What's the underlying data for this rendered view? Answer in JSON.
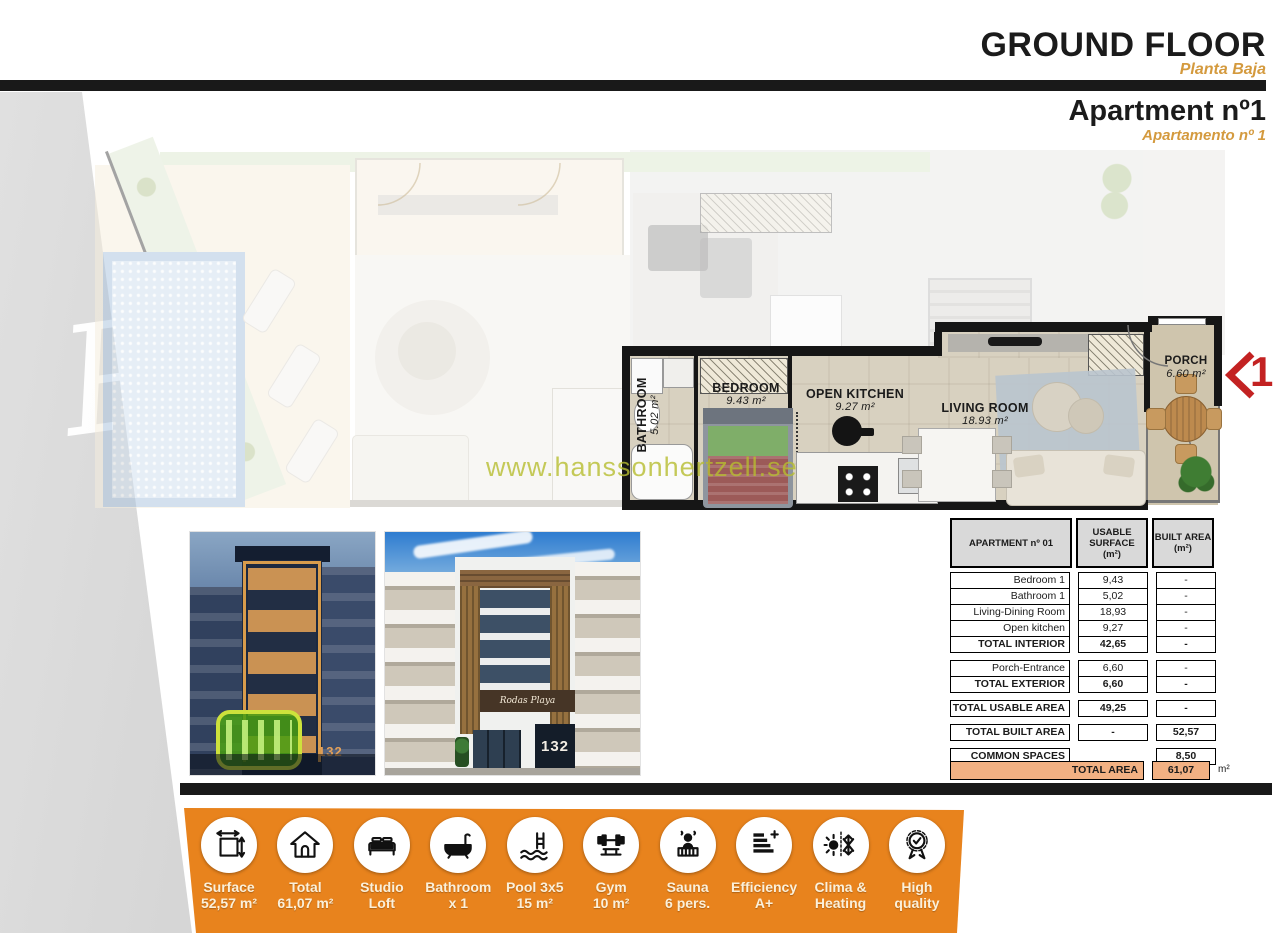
{
  "header": {
    "title": "GROUND FLOOR",
    "subtitle": "Planta Baja",
    "apartment_title": "Apartment nº1",
    "apartment_subtitle": "Apartamento nº 1"
  },
  "floor_plan": {
    "watermark": "www.hanssonhertzell.se",
    "corner_script": "Pl",
    "marker_number": "1",
    "rooms": [
      {
        "name": "BATHROOM",
        "area": "5.02 m²"
      },
      {
        "name": "BEDROOM",
        "area": "9.43 m²"
      },
      {
        "name": "OPEN KITCHEN",
        "area": "9.27 m²"
      },
      {
        "name": "LIVING ROOM",
        "area": "18.93 m²"
      },
      {
        "name": "PORCH",
        "area": "6.60 m²"
      }
    ]
  },
  "photos": {
    "night": {
      "number": "132"
    },
    "day": {
      "number": "132",
      "sign": "Rodas Playa"
    }
  },
  "area_table": {
    "col_headers": [
      {
        "line1": "APARTMENT nº 01",
        "line2": ""
      },
      {
        "line1": "USABLE SURFACE",
        "line2": "(m²)"
      },
      {
        "line1": "BUILT AREA",
        "line2": "(m²)"
      }
    ],
    "groups": [
      {
        "rows": [
          {
            "label": "Bedroom 1",
            "usable": "9,43",
            "built": "-",
            "bold": false
          },
          {
            "label": "Bathroom 1",
            "usable": "5,02",
            "built": "-",
            "bold": false
          },
          {
            "label": "Living-Dining Room",
            "usable": "18,93",
            "built": "-",
            "bold": false
          },
          {
            "label": "Open kitchen",
            "usable": "9,27",
            "built": "-",
            "bold": false
          },
          {
            "label": "TOTAL INTERIOR",
            "usable": "42,65",
            "built": "-",
            "bold": true
          }
        ]
      },
      {
        "rows": [
          {
            "label": "Porch-Entrance",
            "usable": "6,60",
            "built": "-",
            "bold": false
          },
          {
            "label": "TOTAL EXTERIOR",
            "usable": "6,60",
            "built": "-",
            "bold": true
          }
        ]
      },
      {
        "rows": [
          {
            "label": "TOTAL USABLE AREA",
            "usable": "49,25",
            "built": "-",
            "bold": true
          }
        ]
      },
      {
        "rows": [
          {
            "label": "TOTAL BUILT AREA",
            "usable": "-",
            "built": "52,57",
            "bold": true
          }
        ]
      },
      {
        "rows": [
          {
            "label": "COMMON SPACES",
            "usable": "",
            "built": "8,50",
            "bold": true,
            "open_middle": true
          }
        ]
      }
    ],
    "total_row": {
      "label": "TOTAL AREA",
      "value": "61,07",
      "unit": "m²"
    }
  },
  "features": [
    {
      "icon": "surface-icon",
      "line1": "Surface",
      "line2": "52,57 m²"
    },
    {
      "icon": "house-icon",
      "line1": "Total",
      "line2": "61,07 m²"
    },
    {
      "icon": "bed-icon",
      "line1": "Studio",
      "line2": "Loft"
    },
    {
      "icon": "bathtub-icon",
      "line1": "Bathroom",
      "line2": "x 1"
    },
    {
      "icon": "pool-icon",
      "line1": "Pool 3x5",
      "line2": "15 m²"
    },
    {
      "icon": "gym-icon",
      "line1": "Gym",
      "line2": "10 m²"
    },
    {
      "icon": "sauna-icon",
      "line1": "Sauna",
      "line2": "6 pers."
    },
    {
      "icon": "efficiency-icon",
      "line1": "Efficiency",
      "line2": "A+"
    },
    {
      "icon": "climate-icon",
      "line1": "Clima &",
      "line2": "Heating"
    },
    {
      "icon": "quality-icon",
      "line1": "High",
      "line2": "quality"
    }
  ],
  "colors": {
    "accent_orange": "#E8831D",
    "subtitle_orange": "#D49A3E",
    "table_total_bg": "#F2B183",
    "marker_red": "#C32222",
    "watermark_green": "#B7BD30",
    "highlight_green": "#CDE23C"
  }
}
